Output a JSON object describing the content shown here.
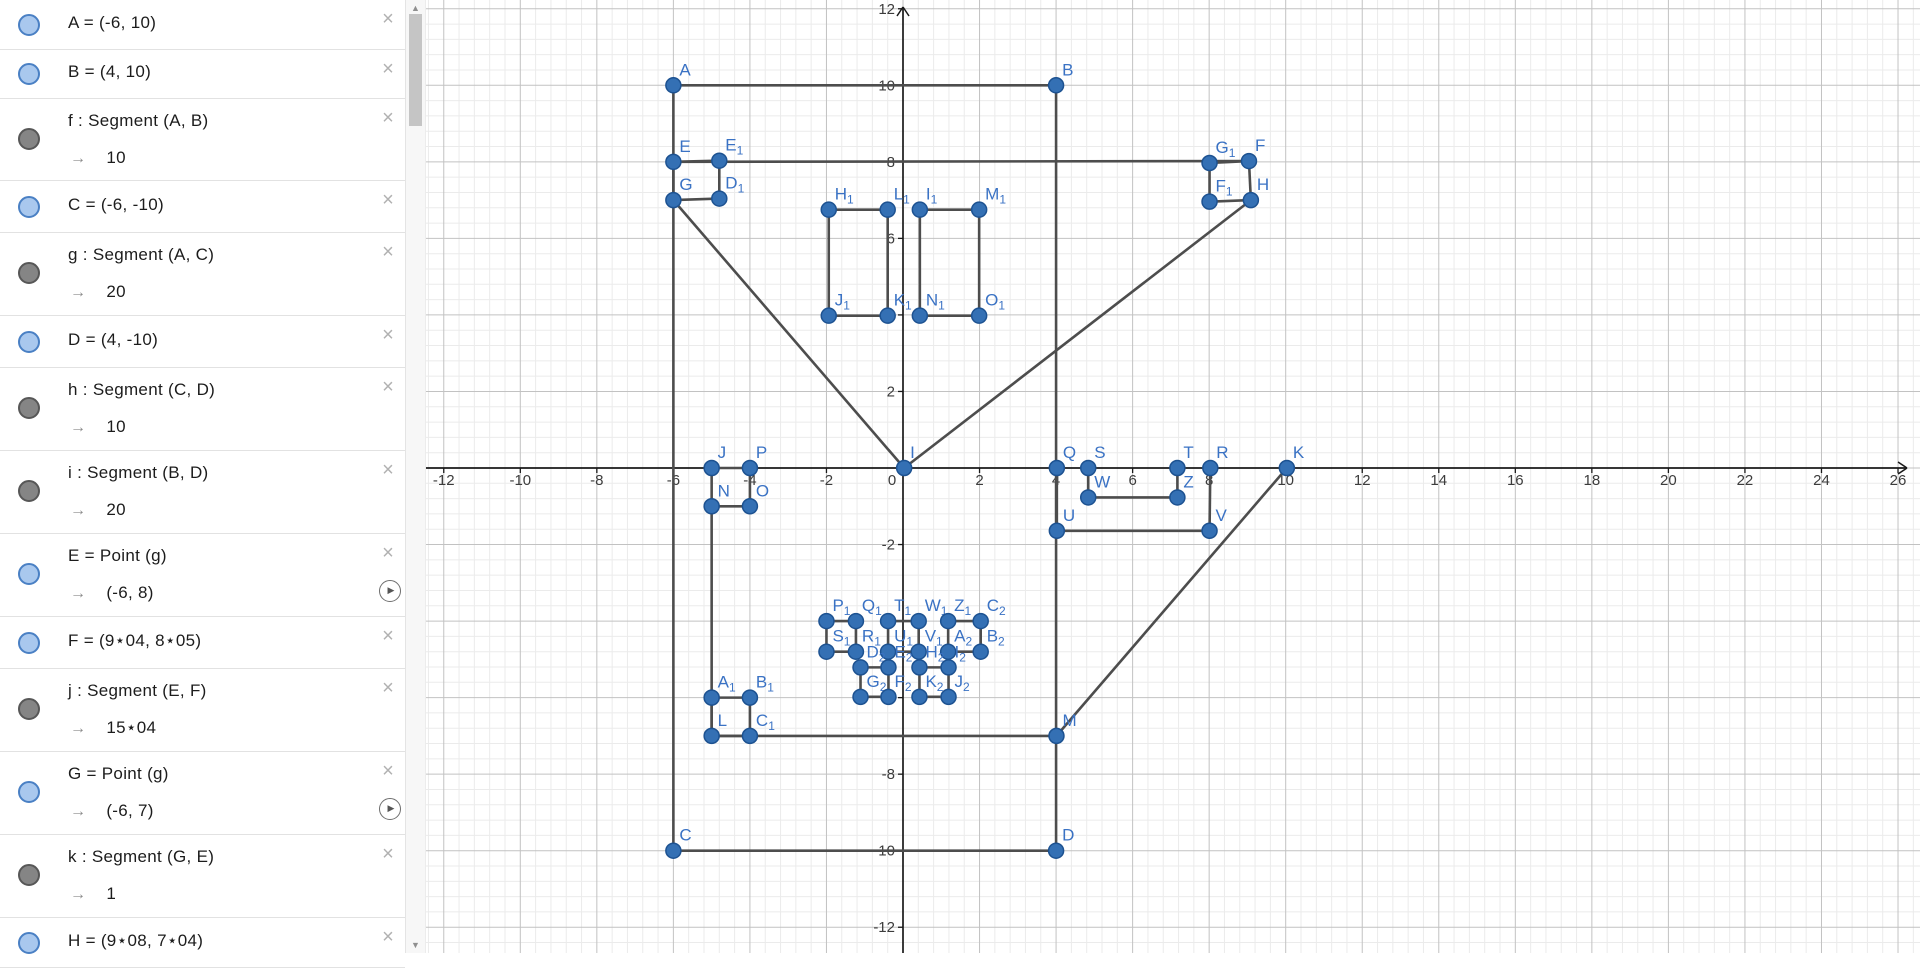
{
  "icons": {
    "close": "×",
    "play": "▶",
    "scroll_up": "▲",
    "scroll_down": "▼",
    "point_toggle": "blue-circle",
    "segment_toggle": "gray-circle"
  },
  "sidebar": {
    "rows": [
      {
        "id": "A",
        "icon": "point",
        "def": "A = (-6, 10)",
        "value": null,
        "h": 49,
        "play": false
      },
      {
        "id": "B",
        "icon": "point",
        "def": "B = (4, 10)",
        "value": null,
        "h": 48,
        "play": false
      },
      {
        "id": "f",
        "icon": "segment",
        "def": "f : Segment (A, B)",
        "value": "10",
        "h": 81,
        "play": false
      },
      {
        "id": "C",
        "icon": "point",
        "def": "C = (-6, -10)",
        "value": null,
        "h": 51,
        "play": false
      },
      {
        "id": "g",
        "icon": "segment",
        "def": "g : Segment (A, C)",
        "value": "20",
        "h": 82,
        "play": false
      },
      {
        "id": "D",
        "icon": "point",
        "def": "D = (4, -10)",
        "value": null,
        "h": 51,
        "play": false
      },
      {
        "id": "h",
        "icon": "segment",
        "def": "h : Segment (C, D)",
        "value": "10",
        "h": 82,
        "play": false
      },
      {
        "id": "i",
        "icon": "segment",
        "def": "i : Segment (B, D)",
        "value": "20",
        "h": 82,
        "play": false
      },
      {
        "id": "E",
        "icon": "point",
        "def": "E = Point (g)",
        "value": "(-6, 8)",
        "h": 82,
        "play": true
      },
      {
        "id": "F",
        "icon": "point",
        "def": "F = (9⋆04, 8⋆05)",
        "value": null,
        "h": 51,
        "play": false
      },
      {
        "id": "j",
        "icon": "segment",
        "def": "j : Segment (E, F)",
        "value": "15⋆04",
        "h": 82,
        "play": false
      },
      {
        "id": "G",
        "icon": "point",
        "def": "G = Point (g)",
        "value": "(-6, 7)",
        "h": 82,
        "play": true
      },
      {
        "id": "k",
        "icon": "segment",
        "def": "k : Segment (G, E)",
        "value": "1",
        "h": 82,
        "play": false
      },
      {
        "id": "H",
        "icon": "point",
        "def": "H = (9⋆08, 7⋆04)",
        "value": null,
        "h": 49,
        "play": false
      }
    ]
  },
  "graph": {
    "origin": [
      477,
      468
    ],
    "unit": 38.27,
    "minor_step": 0.4,
    "x_tick_labels": [
      -12,
      -10,
      -8,
      -6,
      -4,
      -2,
      0,
      2,
      4,
      6,
      8,
      10,
      12,
      14,
      16,
      18,
      20,
      22,
      24,
      26
    ],
    "y_tick_labels": [
      12,
      10,
      8,
      6,
      4,
      2,
      -2,
      -4,
      -6,
      -8,
      -10,
      -12
    ],
    "colors": {
      "minor_grid": "#ebebeb",
      "major_grid": "#c2c2c2",
      "axis": "#1a1a1a",
      "segment": "#4d4d4d",
      "point_fill": "#3470b4",
      "point_stroke": "#1d5291",
      "point_label": "#3a72c4",
      "tick_label": "#3c3c3c"
    },
    "points": [
      {
        "n": "A",
        "x": -6,
        "y": 10
      },
      {
        "n": "B",
        "x": 4,
        "y": 10
      },
      {
        "n": "C",
        "x": -6,
        "y": -10
      },
      {
        "n": "D",
        "x": 4,
        "y": -10
      },
      {
        "n": "E",
        "x": -6,
        "y": 8
      },
      {
        "n": "E1",
        "label": "E",
        "sub": "1",
        "x": -4.8,
        "y": 8.03
      },
      {
        "n": "G",
        "x": -6,
        "y": 7
      },
      {
        "n": "D1",
        "label": "D",
        "sub": "1",
        "x": -4.8,
        "y": 7.04
      },
      {
        "n": "G1",
        "label": "G",
        "sub": "1",
        "x": 8.01,
        "y": 7.97
      },
      {
        "n": "F",
        "x": 9.04,
        "y": 8.02
      },
      {
        "n": "F1",
        "label": "F",
        "sub": "1",
        "x": 8.01,
        "y": 6.96
      },
      {
        "n": "H",
        "x": 9.09,
        "y": 7.0
      },
      {
        "n": "H1",
        "label": "H",
        "sub": "1",
        "x": -1.94,
        "y": 6.75
      },
      {
        "n": "L1",
        "label": "L",
        "sub": "1",
        "x": -0.4,
        "y": 6.75
      },
      {
        "n": "J1",
        "label": "J",
        "sub": "1",
        "x": -1.94,
        "y": 3.98
      },
      {
        "n": "K1",
        "label": "K",
        "sub": "1",
        "x": -0.4,
        "y": 3.98
      },
      {
        "n": "I1",
        "label": "I",
        "sub": "1",
        "x": 0.44,
        "y": 6.75
      },
      {
        "n": "M1",
        "label": "M",
        "sub": "1",
        "x": 1.99,
        "y": 6.75
      },
      {
        "n": "N1",
        "label": "N",
        "sub": "1",
        "x": 0.44,
        "y": 3.98
      },
      {
        "n": "O1",
        "label": "O",
        "sub": "1",
        "x": 1.99,
        "y": 3.98
      },
      {
        "n": "J",
        "x": -5,
        "y": 0
      },
      {
        "n": "P",
        "x": -4,
        "y": 0
      },
      {
        "n": "N",
        "x": -5,
        "y": -1
      },
      {
        "n": "O",
        "x": -4,
        "y": -1
      },
      {
        "n": "I",
        "x": 0.03,
        "y": 0
      },
      {
        "n": "Q",
        "x": 4.02,
        "y": 0
      },
      {
        "n": "S",
        "x": 4.84,
        "y": 0
      },
      {
        "n": "T",
        "x": 7.17,
        "y": 0
      },
      {
        "n": "R",
        "x": 8.03,
        "y": 0
      },
      {
        "n": "K",
        "x": 10.03,
        "y": 0
      },
      {
        "n": "W",
        "x": 4.84,
        "y": -0.77
      },
      {
        "n": "Z",
        "x": 7.17,
        "y": -0.77
      },
      {
        "n": "U",
        "x": 4.02,
        "y": -1.64
      },
      {
        "n": "V",
        "x": 8.01,
        "y": -1.64
      },
      {
        "n": "M",
        "x": 4.01,
        "y": -7
      },
      {
        "n": "A1",
        "label": "A",
        "sub": "1",
        "x": -5,
        "y": -6
      },
      {
        "n": "B1",
        "label": "B",
        "sub": "1",
        "x": -4,
        "y": -6
      },
      {
        "n": "L",
        "x": -5,
        "y": -7
      },
      {
        "n": "C1",
        "label": "C",
        "sub": "1",
        "x": -4,
        "y": -7
      },
      {
        "n": "P1",
        "label": "P",
        "sub": "1",
        "x": -2,
        "y": -4
      },
      {
        "n": "Q1",
        "label": "Q",
        "sub": "1",
        "x": -1.23,
        "y": -4
      },
      {
        "n": "T1",
        "label": "T",
        "sub": "1",
        "x": -0.39,
        "y": -4
      },
      {
        "n": "W1",
        "label": "W",
        "sub": "1",
        "x": 0.41,
        "y": -4
      },
      {
        "n": "Z1",
        "label": "Z",
        "sub": "1",
        "x": 1.18,
        "y": -4
      },
      {
        "n": "C2",
        "label": "C",
        "sub": "2",
        "x": 2.03,
        "y": -4
      },
      {
        "n": "S1",
        "label": "S",
        "sub": "1",
        "x": -2,
        "y": -4.8
      },
      {
        "n": "R1",
        "label": "R",
        "sub": "1",
        "x": -1.23,
        "y": -4.8
      },
      {
        "n": "U1",
        "label": "U",
        "sub": "1",
        "x": -0.39,
        "y": -4.8
      },
      {
        "n": "V1",
        "label": "V",
        "sub": "1",
        "x": 0.41,
        "y": -4.8
      },
      {
        "n": "A2",
        "label": "A",
        "sub": "2",
        "x": 1.18,
        "y": -4.8
      },
      {
        "n": "B2",
        "label": "B",
        "sub": "2",
        "x": 2.03,
        "y": -4.8
      },
      {
        "n": "D2",
        "label": "D",
        "sub": "2",
        "x": -1.11,
        "y": -5.21
      },
      {
        "n": "E2",
        "label": "E",
        "sub": "2",
        "x": -0.38,
        "y": -5.21
      },
      {
        "n": "H2",
        "label": "H",
        "sub": "2",
        "x": 0.43,
        "y": -5.21
      },
      {
        "n": "I2",
        "label": "I",
        "sub": "2",
        "x": 1.19,
        "y": -5.21
      },
      {
        "n": "G2",
        "label": "G",
        "sub": "2",
        "x": -1.11,
        "y": -5.98
      },
      {
        "n": "F2",
        "label": "F",
        "sub": "2",
        "x": -0.38,
        "y": -5.98
      },
      {
        "n": "K2",
        "label": "K",
        "sub": "2",
        "x": 0.43,
        "y": -5.98
      },
      {
        "n": "J2",
        "label": "J",
        "sub": "2",
        "x": 1.19,
        "y": -5.98
      }
    ],
    "segments": [
      [
        "A",
        "B"
      ],
      [
        "A",
        "C"
      ],
      [
        "C",
        "D"
      ],
      [
        "B",
        "D"
      ],
      [
        "E",
        "F"
      ],
      [
        "G",
        "E"
      ],
      [
        "E",
        "E1"
      ],
      [
        "E1",
        "D1"
      ],
      [
        "D1",
        "G"
      ],
      [
        "G",
        "I"
      ],
      [
        "I",
        "H"
      ],
      [
        "G1",
        "F"
      ],
      [
        "F",
        "H"
      ],
      [
        "H",
        "F1"
      ],
      [
        "F1",
        "G1"
      ],
      [
        "H1",
        "L1"
      ],
      [
        "L1",
        "K1"
      ],
      [
        "K1",
        "J1"
      ],
      [
        "J1",
        "H1"
      ],
      [
        "I1",
        "M1"
      ],
      [
        "M1",
        "O1"
      ],
      [
        "O1",
        "N1"
      ],
      [
        "N1",
        "I1"
      ],
      [
        "J",
        "P"
      ],
      [
        "P",
        "O"
      ],
      [
        "O",
        "N"
      ],
      [
        "N",
        "J"
      ],
      [
        "N",
        "L"
      ],
      [
        "A1",
        "B1"
      ],
      [
        "B1",
        "C1"
      ],
      [
        "C1",
        "L"
      ],
      [
        "L",
        "A1"
      ],
      [
        "L",
        "M"
      ],
      [
        "M",
        "K"
      ],
      [
        "Q",
        "U"
      ],
      [
        "U",
        "V"
      ],
      [
        "V",
        "R"
      ],
      [
        "S",
        "W"
      ],
      [
        "W",
        "Z"
      ],
      [
        "Z",
        "T"
      ],
      [
        "P1",
        "Q1"
      ],
      [
        "Q1",
        "R1"
      ],
      [
        "R1",
        "S1"
      ],
      [
        "S1",
        "P1"
      ],
      [
        "T1",
        "W1"
      ],
      [
        "W1",
        "V1"
      ],
      [
        "V1",
        "U1"
      ],
      [
        "U1",
        "T1"
      ],
      [
        "Z1",
        "C2"
      ],
      [
        "C2",
        "B2"
      ],
      [
        "B2",
        "A2"
      ],
      [
        "A2",
        "Z1"
      ],
      [
        "D2",
        "E2"
      ],
      [
        "E2",
        "F2"
      ],
      [
        "F2",
        "G2"
      ],
      [
        "G2",
        "D2"
      ],
      [
        "H2",
        "I2"
      ],
      [
        "I2",
        "J2"
      ],
      [
        "J2",
        "K2"
      ],
      [
        "K2",
        "H2"
      ]
    ]
  }
}
